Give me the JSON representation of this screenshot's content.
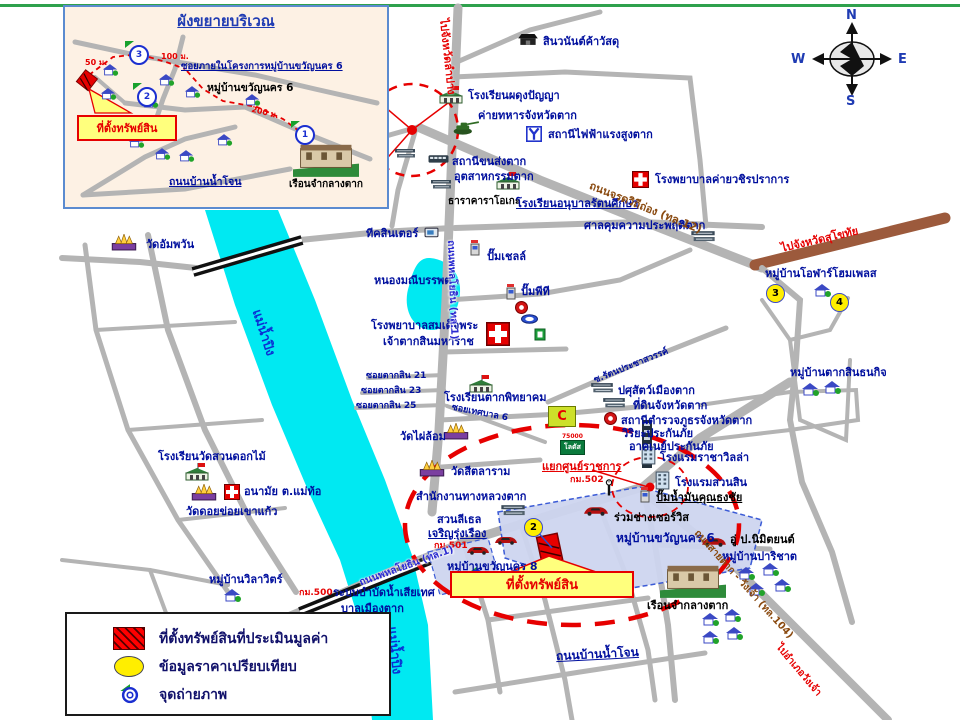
{
  "compass": {
    "n": "N",
    "e": "E",
    "w": "W",
    "s": "S"
  },
  "inset": {
    "title": "ผังขยายบริเวณ",
    "soi": "ซอยภายในโครงการหมู่บ้านขวัญนคร 6",
    "village": "หมู่บ้านขวัญนคร 6",
    "callout": "ที่ตั้งทรัพย์สิน",
    "road": "ถนนบ้านน้ำโจน",
    "prison": "เรือนจำกลางตาก",
    "d50": "50 ม.",
    "d100": "100 ม.",
    "d200": "200 ม.",
    "p1": "1",
    "p2": "2",
    "p3": "3"
  },
  "legend": {
    "property": "ที่ตั้งทรัพย์สินที่ประเมินมูลค่า",
    "compare": "ข้อมูลราคาเปรียบเทียบ",
    "photo": "จุดถ่ายภาพ"
  },
  "map": {
    "markers": {
      "m1": "1",
      "m2": "2",
      "m3": "3",
      "m4": "4"
    },
    "labels": {
      "river1": "แม่น้ำปิง",
      "river2": "แม่น้ำปิง",
      "lake": "หนองมณีบรรพต",
      "to_lampang": "ไปจังหวัดลำปาง",
      "to_sukhothai": "ไปจังหวัดสุโขทัย",
      "to_wangchao": "ไปอำเภอวังเจ้า",
      "rd_phahon_n": "ถนนพหลโยธิน (ทล.1)",
      "rd_phahon_s": "ถนนพหลโยธิน (ทล.1)",
      "rd_jarodvithi": "ถนนจรดวิถีถ่อง (ทล.12)",
      "rd_tak_wangchao": "ถนนสายตาก - วังเจ้า (ทล.104)",
      "rd_bannamjone": "ถนนบ้านน้ำโจน",
      "sinwanan": "สินวนันต์ค้าวัสดุ",
      "phadung": "โรงเรียนผดุงปัญญา",
      "army": "ค่ายทหารจังหวัดตาก",
      "power": "สถานีไฟฟ้าแรงสูงตาก",
      "hosp_camp": "โรงพยาบาลค่ายวชิรปราการ",
      "bus": "สถานีขนส่งตาก",
      "industry": "อุตสาหกรรมตาก",
      "karaoke": "ธาราคาราโอเกะ",
      "anuban": "โรงเรียนอนุบาลรัตนศึกษา",
      "probation": "ศาลคุมความประพฤติตาก",
      "wat_ampawan": "วัดอัมพวัน",
      "teak": "ทีคสินเตอร์",
      "shell": "ปั๊มเชลล์",
      "pt": "ปั๊มพีที",
      "hosp_taksin1": "โรงพยาบาลสมเด็จพระ",
      "hosp_taksin2": "เจ้าตากสินมหาราช",
      "soi21": "ซอยตากสิน 21",
      "soi23": "ซอยตากสิน 23",
      "soi25": "ซอยตากสิน 25",
      "takpit": "โรงเรียนตากพิทยาคม",
      "soi_tessaban": "ซอยเทศบาล 6",
      "wat_phai": "วัดไผ่ล้อม",
      "bigc": "C",
      "lotus": "โลตัส",
      "lotus_num": "75000",
      "wat_sitalaram": "วัดสีตลาราม",
      "highway_office": "สำนักงานทางหลวงตาก",
      "junction": "แยกศูนย์ราชการ",
      "km500": "กม.500",
      "km501": "กม.501",
      "km502": "กม.502",
      "livestock": "ปศุสัตว์เมืองตาก",
      "land": "ที่ดินจังหวัดตาก",
      "police": "สถานีตำรวจภูธรจังหวัดตาก",
      "viriya": "วิริยะประกันภัย",
      "southeast": "อาคเนย์ประกันภัย",
      "hotel_racha": "โรงแรมราชาวิลล่า",
      "hotel_suansin": "โรงแรมสวนสิน",
      "gas_thongchai": "ปั๊มน้ำมันคุณธงชัย",
      "garage": "ร่วมช่างเซอร์วิส",
      "kwan6": "หมู่บ้านขวัญนคร 6",
      "kwan8": "หมู่บ้านขวัญนคร 8",
      "property": "ที่ตั้งทรัพย์สิน",
      "prison": "เรือนจำกลางตาก",
      "nimit": "อู่ ป.นิมิตยนต์",
      "parichat": "หมู่บ้านปาริชาต",
      "taksin_thanakit": "หมู่บ้านตากสินธนกิจ",
      "olan": "หมู่บ้านโอฬาร์โฮมเพลส",
      "soi_rattana": "ซ.รัตนประชาสวรรค์",
      "suandok": "โรงเรียนวัดสวนดอกไม้",
      "anamai": "อนามัย ต.แม่ท้อ",
      "wat_doi": "วัดดอยข่อยเขาแก้ว",
      "wilawit": "หมู่บ้านวิลาวิตร์",
      "wastewater1": "ระบบบำบัดน้ำเสียเทศ",
      "wastewater2": "บาลเมืองตาก",
      "suanlethel": "สวนลีเธล",
      "charoen": "เจริญรุ่งเรือง"
    }
  }
}
